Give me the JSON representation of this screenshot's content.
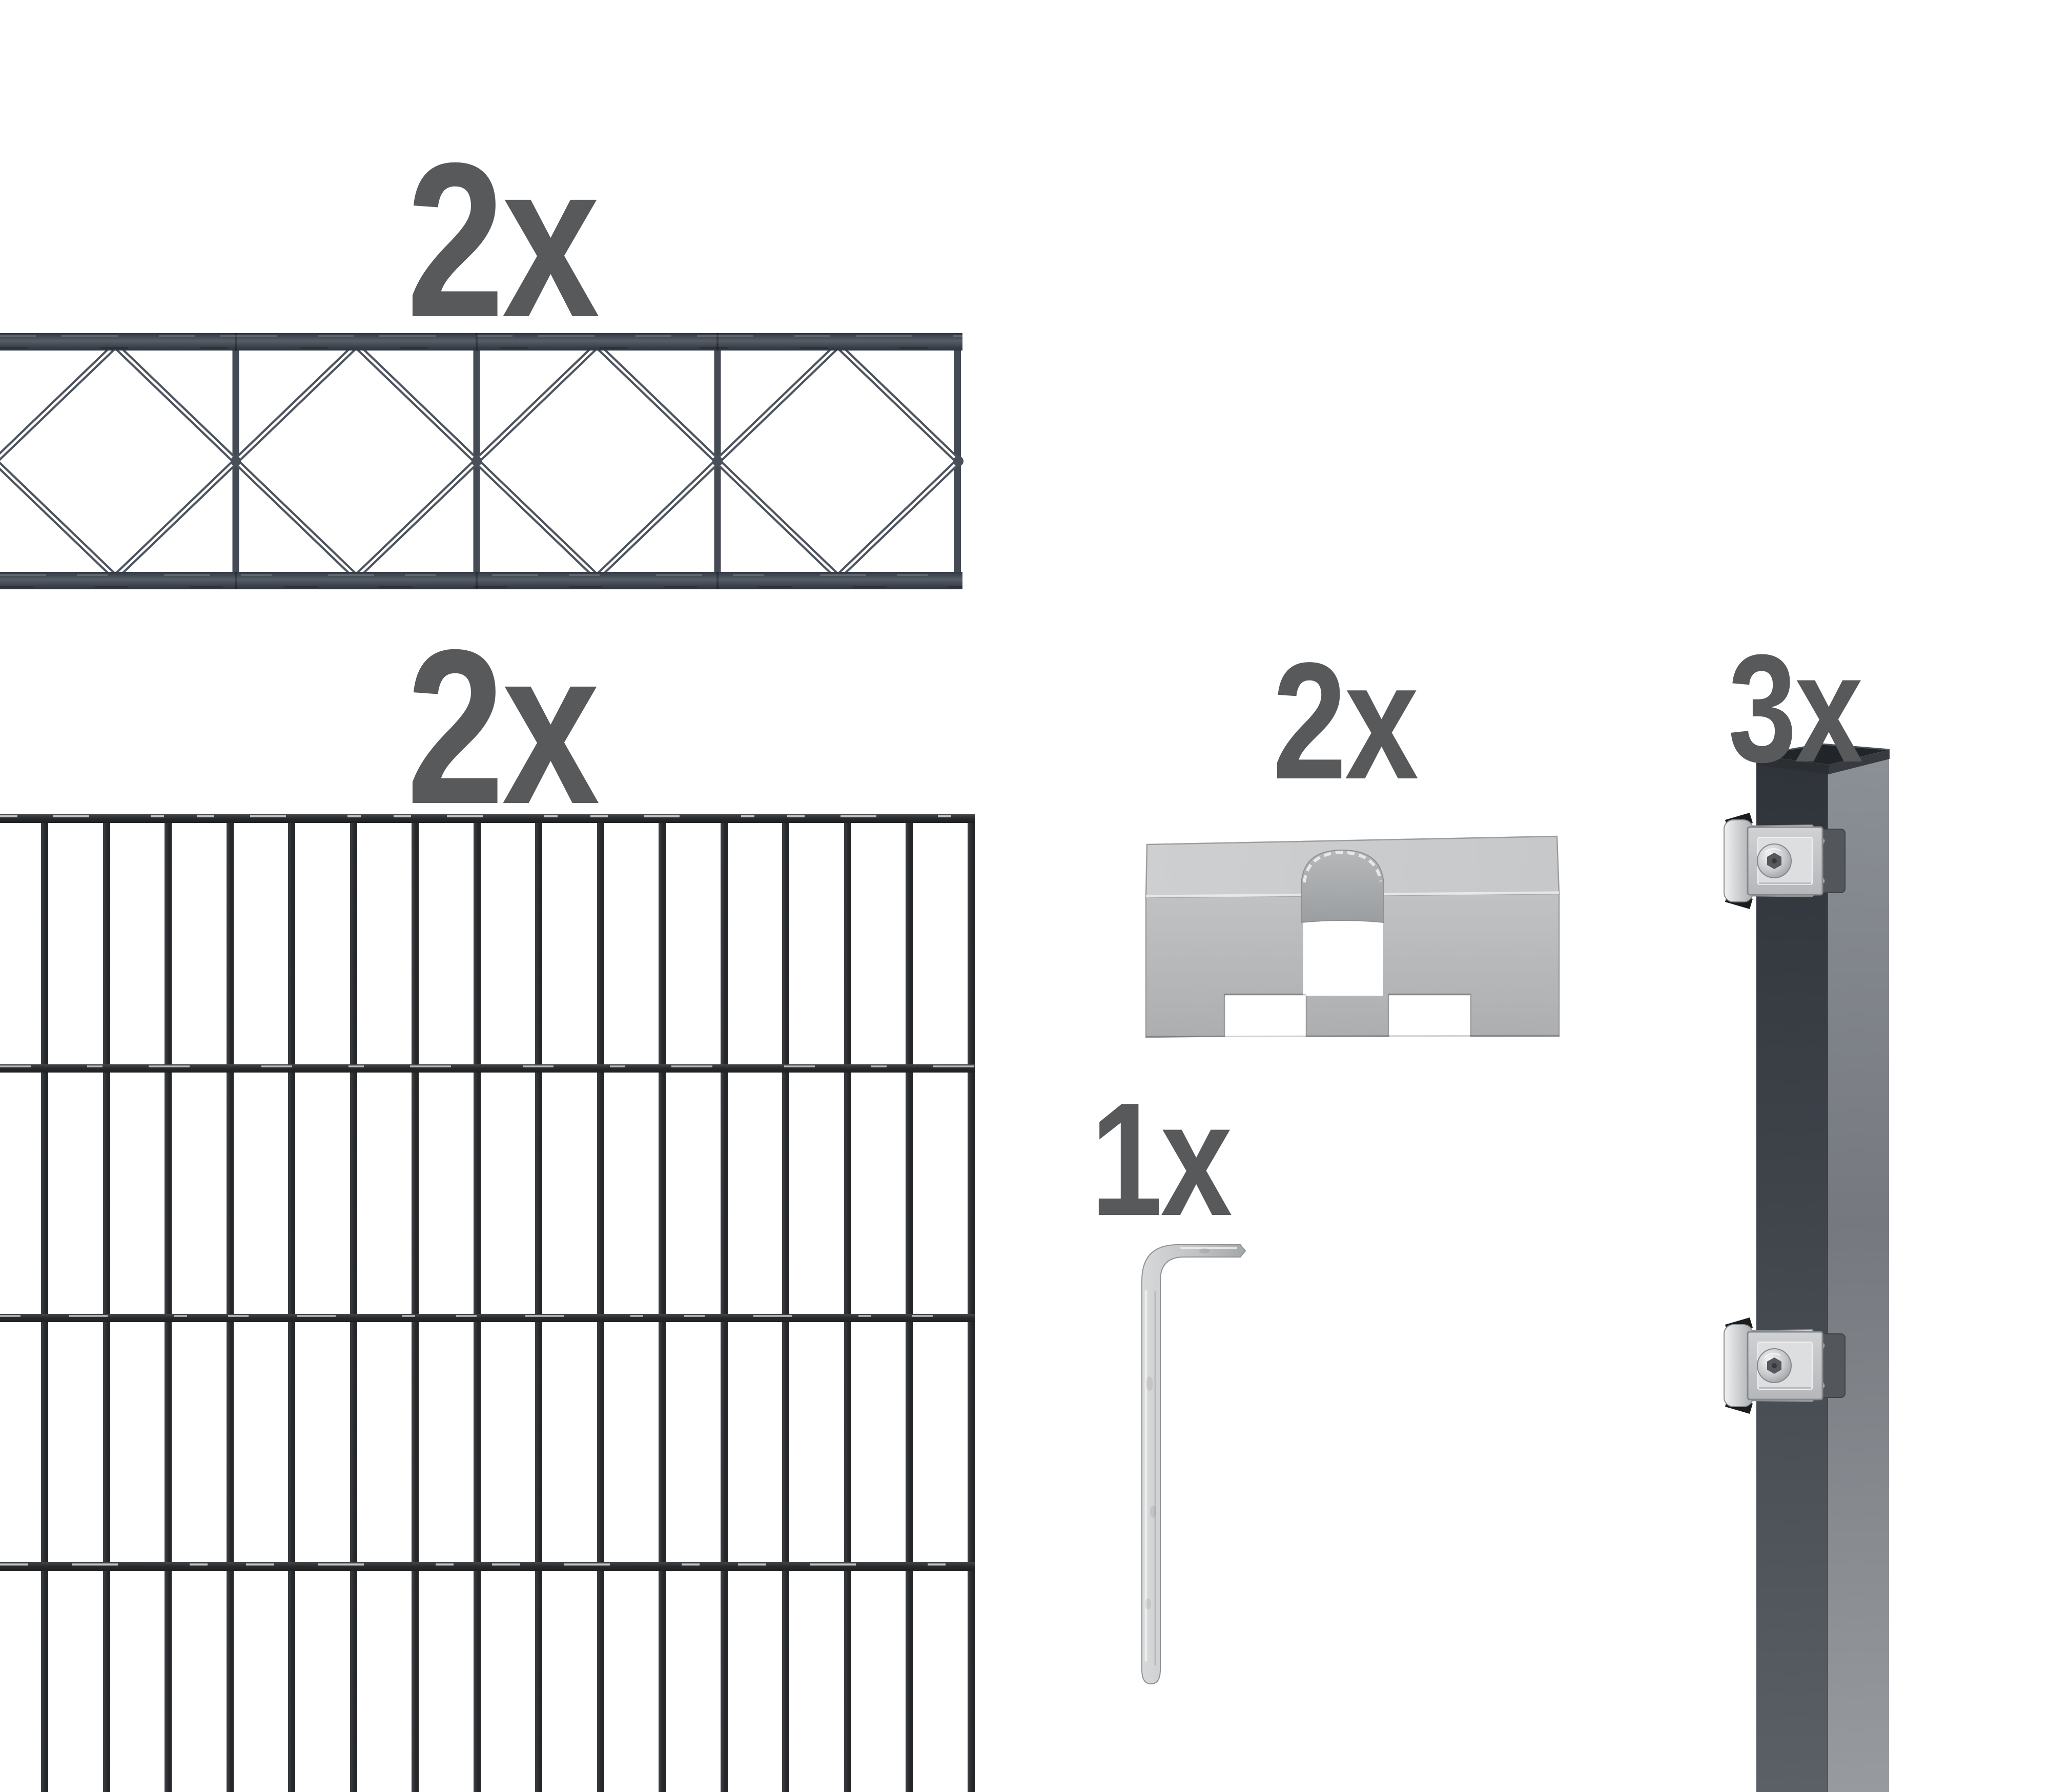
{
  "title": "fence kit parts overview",
  "quantities": {
    "ornamental_panel": "2x",
    "mesh_panel": "2x",
    "cover_bracket": "2x",
    "post": "3x",
    "allen_key": "1x"
  },
  "colors": {
    "background": "#ffffff",
    "label-gray": "#58595b",
    "panel-anthracite": "#4d535d",
    "mesh-anthracite": "#2c2f31",
    "post-front": "#3c4147",
    "post-side": "#84888e",
    "steel-light": "#d7d8da",
    "steel-mid": "#b3b6b8"
  }
}
